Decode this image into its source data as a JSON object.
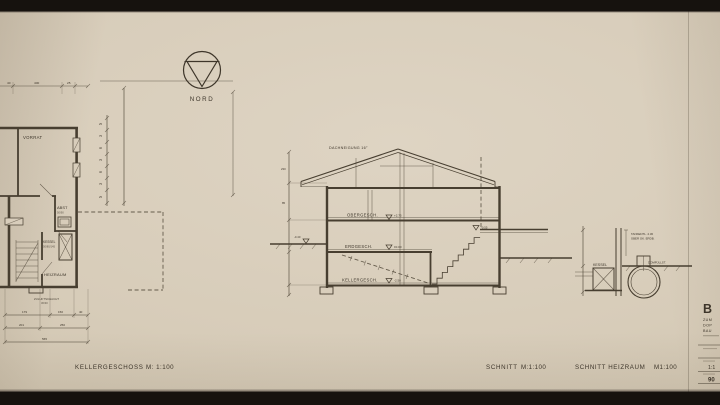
{
  "colors": {
    "paper": "#d8cdbb",
    "ink": "#423a2d",
    "scan_band": "#17130f"
  },
  "north": {
    "label": "NORD"
  },
  "plan": {
    "title": "KELLERGESCHOSS",
    "scale": "M: 1:100",
    "rooms": {
      "vorrat": "VORRAT",
      "abst": "ABST",
      "heizraum": "HEIZRAUM"
    },
    "abst_note": "50/90",
    "kessel_label": "KESSEL",
    "kessel_note": "50/80/145",
    "zuluft_label": "ZULUFTSCHACHT",
    "zuluft_note": "30/30",
    "dims": {
      "top": [
        "40",
        "400",
        "25"
      ],
      "side": [
        "25",
        "75",
        "40",
        "75",
        "40",
        "75",
        "25"
      ],
      "bottom_row1": [
        "179",
        "150",
        "40"
      ],
      "bottom_row2": [
        "201",
        "250"
      ],
      "bottom_total": "565"
    }
  },
  "section": {
    "title": "SCHNITT",
    "scale": "M:1:100",
    "roof_note": "DACHNEIGUNG 16°",
    "floors": [
      {
        "label": "OBERGESCH.",
        "level": "+2.75"
      },
      {
        "label": "ERDGESCH.",
        "level": "±0.00"
      },
      {
        "label": "KELLERGESCH.",
        "level": "-2.50"
      }
    ],
    "grades": {
      "left": "-0.40",
      "right": "-0.55"
    },
    "dims_left": [
      "230",
      "85"
    ]
  },
  "detail": {
    "title": "SCHNITT HEIZRAUM",
    "scale": "M1:100",
    "kessel_label": "KESSEL",
    "tank_note_line1": "TANKENTL. 2.30",
    "tank_note_line2": "ÜBER OK. ERDB.",
    "dome_label": "DOMFÜLLST."
  },
  "titleblock": {
    "big_letter": "B",
    "line1": "ZUM",
    "line2": "DOP",
    "line3": "BAU",
    "scale_value": "1:1",
    "sheet_number": "90"
  }
}
